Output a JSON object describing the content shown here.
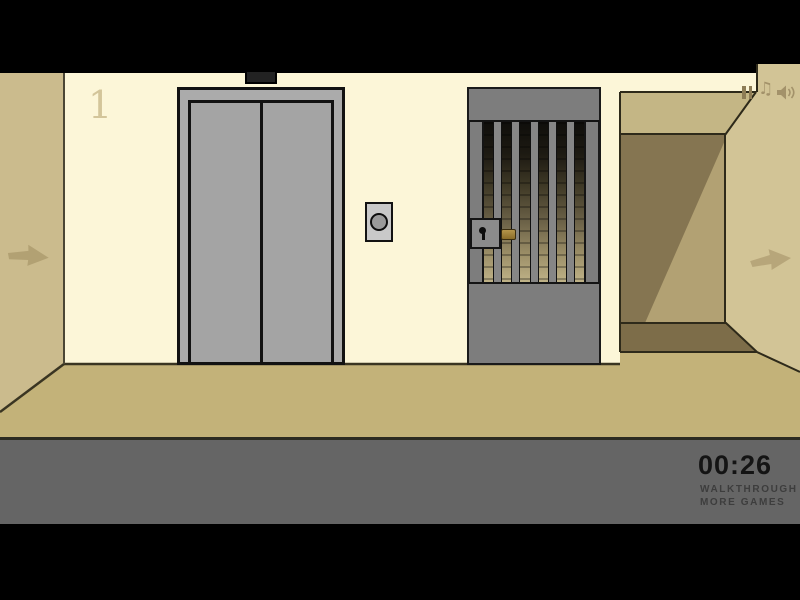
{
  "scene": {
    "floor_label": "1",
    "colors": {
      "back_wall": "#fcf6d8",
      "left_wall": "#cbbb8d",
      "right_wall": "#d2c496",
      "corridor_ceiling": "#c4b685",
      "corridor_dark": "#857551",
      "corridor_light": "#b2a173",
      "floor": "#c3b279",
      "elevator_gray": "#ababab",
      "gate_gray": "#7d7d7d",
      "brass_latch": "#a5853b",
      "footer_gray": "#656565",
      "timer_text": "#141414",
      "link_text": "#3d3d3d",
      "icon_tan": "#a3926a"
    }
  },
  "icons": {
    "pause": "pause-icon",
    "music_note": "music-note-icon",
    "music_glyph": "♫",
    "speaker": "speaker-icon",
    "left_arrow": "left-arrow-icon",
    "right_arrow": "right-arrow-icon"
  },
  "footer": {
    "timer": "00:26",
    "walkthrough_label": "WALKTHROUGH",
    "more_games_label": "MORE GAMES"
  }
}
